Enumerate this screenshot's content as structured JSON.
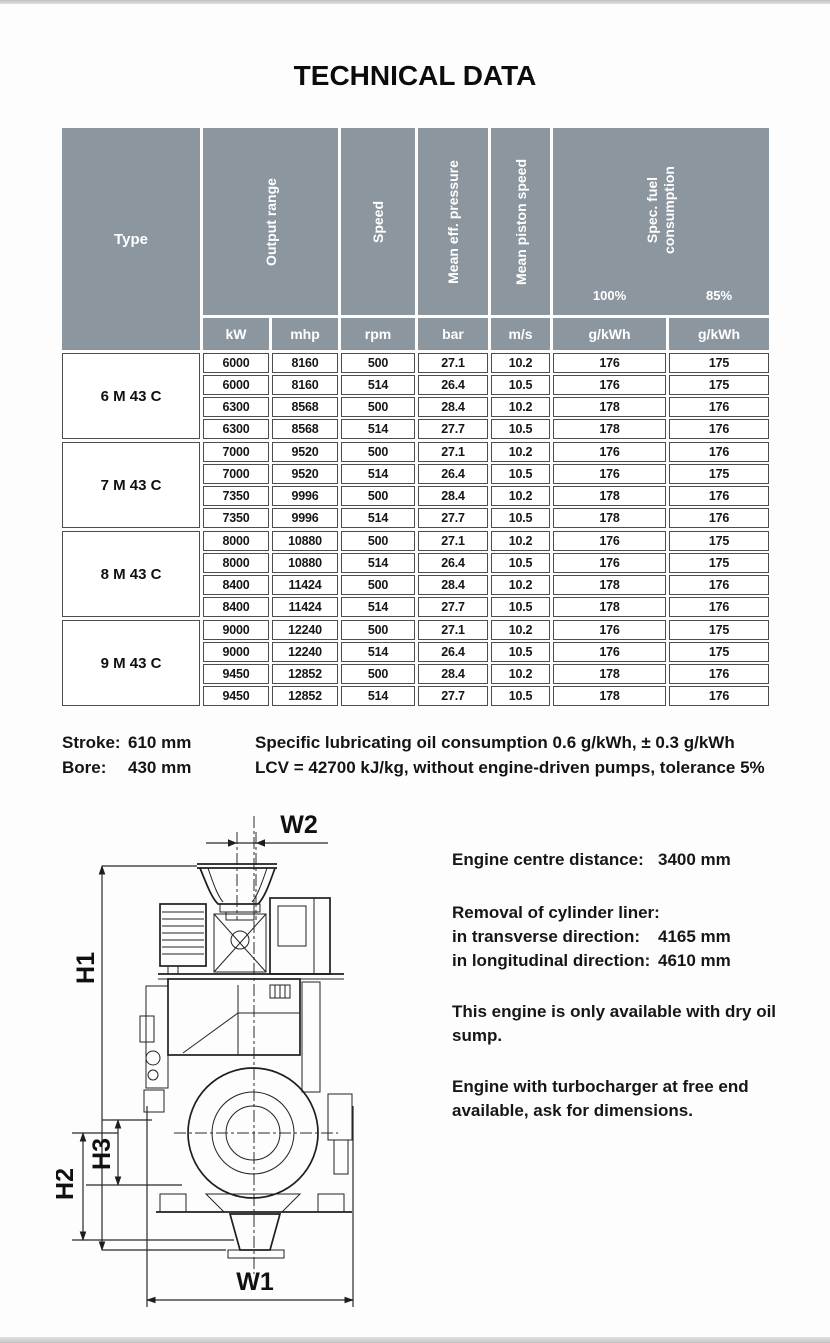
{
  "page": {
    "title": "TECHNICAL DATA"
  },
  "table": {
    "header": {
      "type": "Type",
      "output_range": "Output range",
      "speed": "Speed",
      "mean_eff_pressure": "Mean eff. pressure",
      "mean_piston_speed": "Mean piston speed",
      "spec_fuel_line1": "Spec. fuel",
      "spec_fuel_line2": "consumption",
      "load_100": "100%",
      "load_85": "85%",
      "units": {
        "kw": "kW",
        "mhp": "mhp",
        "rpm": "rpm",
        "bar": "bar",
        "ms": "m/s",
        "g100": "g/kWh",
        "g85": "g/kWh"
      }
    },
    "groups": [
      {
        "type": "6 M 43 C",
        "rows": [
          [
            "6000",
            "8160",
            "500",
            "27.1",
            "10.2",
            "176",
            "175"
          ],
          [
            "6000",
            "8160",
            "514",
            "26.4",
            "10.5",
            "176",
            "175"
          ],
          [
            "6300",
            "8568",
            "500",
            "28.4",
            "10.2",
            "178",
            "176"
          ],
          [
            "6300",
            "8568",
            "514",
            "27.7",
            "10.5",
            "178",
            "176"
          ]
        ]
      },
      {
        "type": "7 M 43 C",
        "rows": [
          [
            "7000",
            "9520",
            "500",
            "27.1",
            "10.2",
            "176",
            "176"
          ],
          [
            "7000",
            "9520",
            "514",
            "26.4",
            "10.5",
            "176",
            "175"
          ],
          [
            "7350",
            "9996",
            "500",
            "28.4",
            "10.2",
            "178",
            "176"
          ],
          [
            "7350",
            "9996",
            "514",
            "27.7",
            "10.5",
            "178",
            "176"
          ]
        ]
      },
      {
        "type": "8 M 43 C",
        "rows": [
          [
            "8000",
            "10880",
            "500",
            "27.1",
            "10.2",
            "176",
            "175"
          ],
          [
            "8000",
            "10880",
            "514",
            "26.4",
            "10.5",
            "176",
            "175"
          ],
          [
            "8400",
            "11424",
            "500",
            "28.4",
            "10.2",
            "178",
            "176"
          ],
          [
            "8400",
            "11424",
            "514",
            "27.7",
            "10.5",
            "178",
            "176"
          ]
        ]
      },
      {
        "type": "9 M 43 C",
        "rows": [
          [
            "9000",
            "12240",
            "500",
            "27.1",
            "10.2",
            "176",
            "175"
          ],
          [
            "9000",
            "12240",
            "514",
            "26.4",
            "10.5",
            "176",
            "175"
          ],
          [
            "9450",
            "12852",
            "500",
            "28.4",
            "10.2",
            "178",
            "176"
          ],
          [
            "9450",
            "12852",
            "514",
            "27.7",
            "10.5",
            "178",
            "176"
          ]
        ]
      }
    ]
  },
  "notes": {
    "stroke_label": "Stroke:",
    "stroke_value": "610 mm",
    "bore_label": "Bore:",
    "bore_value": "430 mm",
    "lube_line": "Specific lubricating oil consumption 0.6 g/kWh, ± 0.3 g/kWh",
    "lcv_line": "LCV = 42700 kJ/kg, without engine-driven pumps, tolerance 5%"
  },
  "dimension_info": {
    "centre_label": "Engine centre distance:",
    "centre_value": "3400 mm",
    "liner_heading": "Removal of cylinder liner:",
    "transverse_label": "in transverse direction:",
    "transverse_value": "4165 mm",
    "longitudinal_label": "in longitudinal direction:",
    "longitudinal_value": "4610 mm",
    "dry_sump_note": "This engine is only available with dry oil sump.",
    "turbo_note": "Engine with turbocharger at free end available, ask for dimensions."
  },
  "drawing": {
    "labels": {
      "w1": "W1",
      "w2": "W2",
      "h1": "H1",
      "h2": "H2",
      "h3": "H3"
    }
  },
  "colors": {
    "header_bg": "#8c969f",
    "border": "#4d4d4d"
  }
}
